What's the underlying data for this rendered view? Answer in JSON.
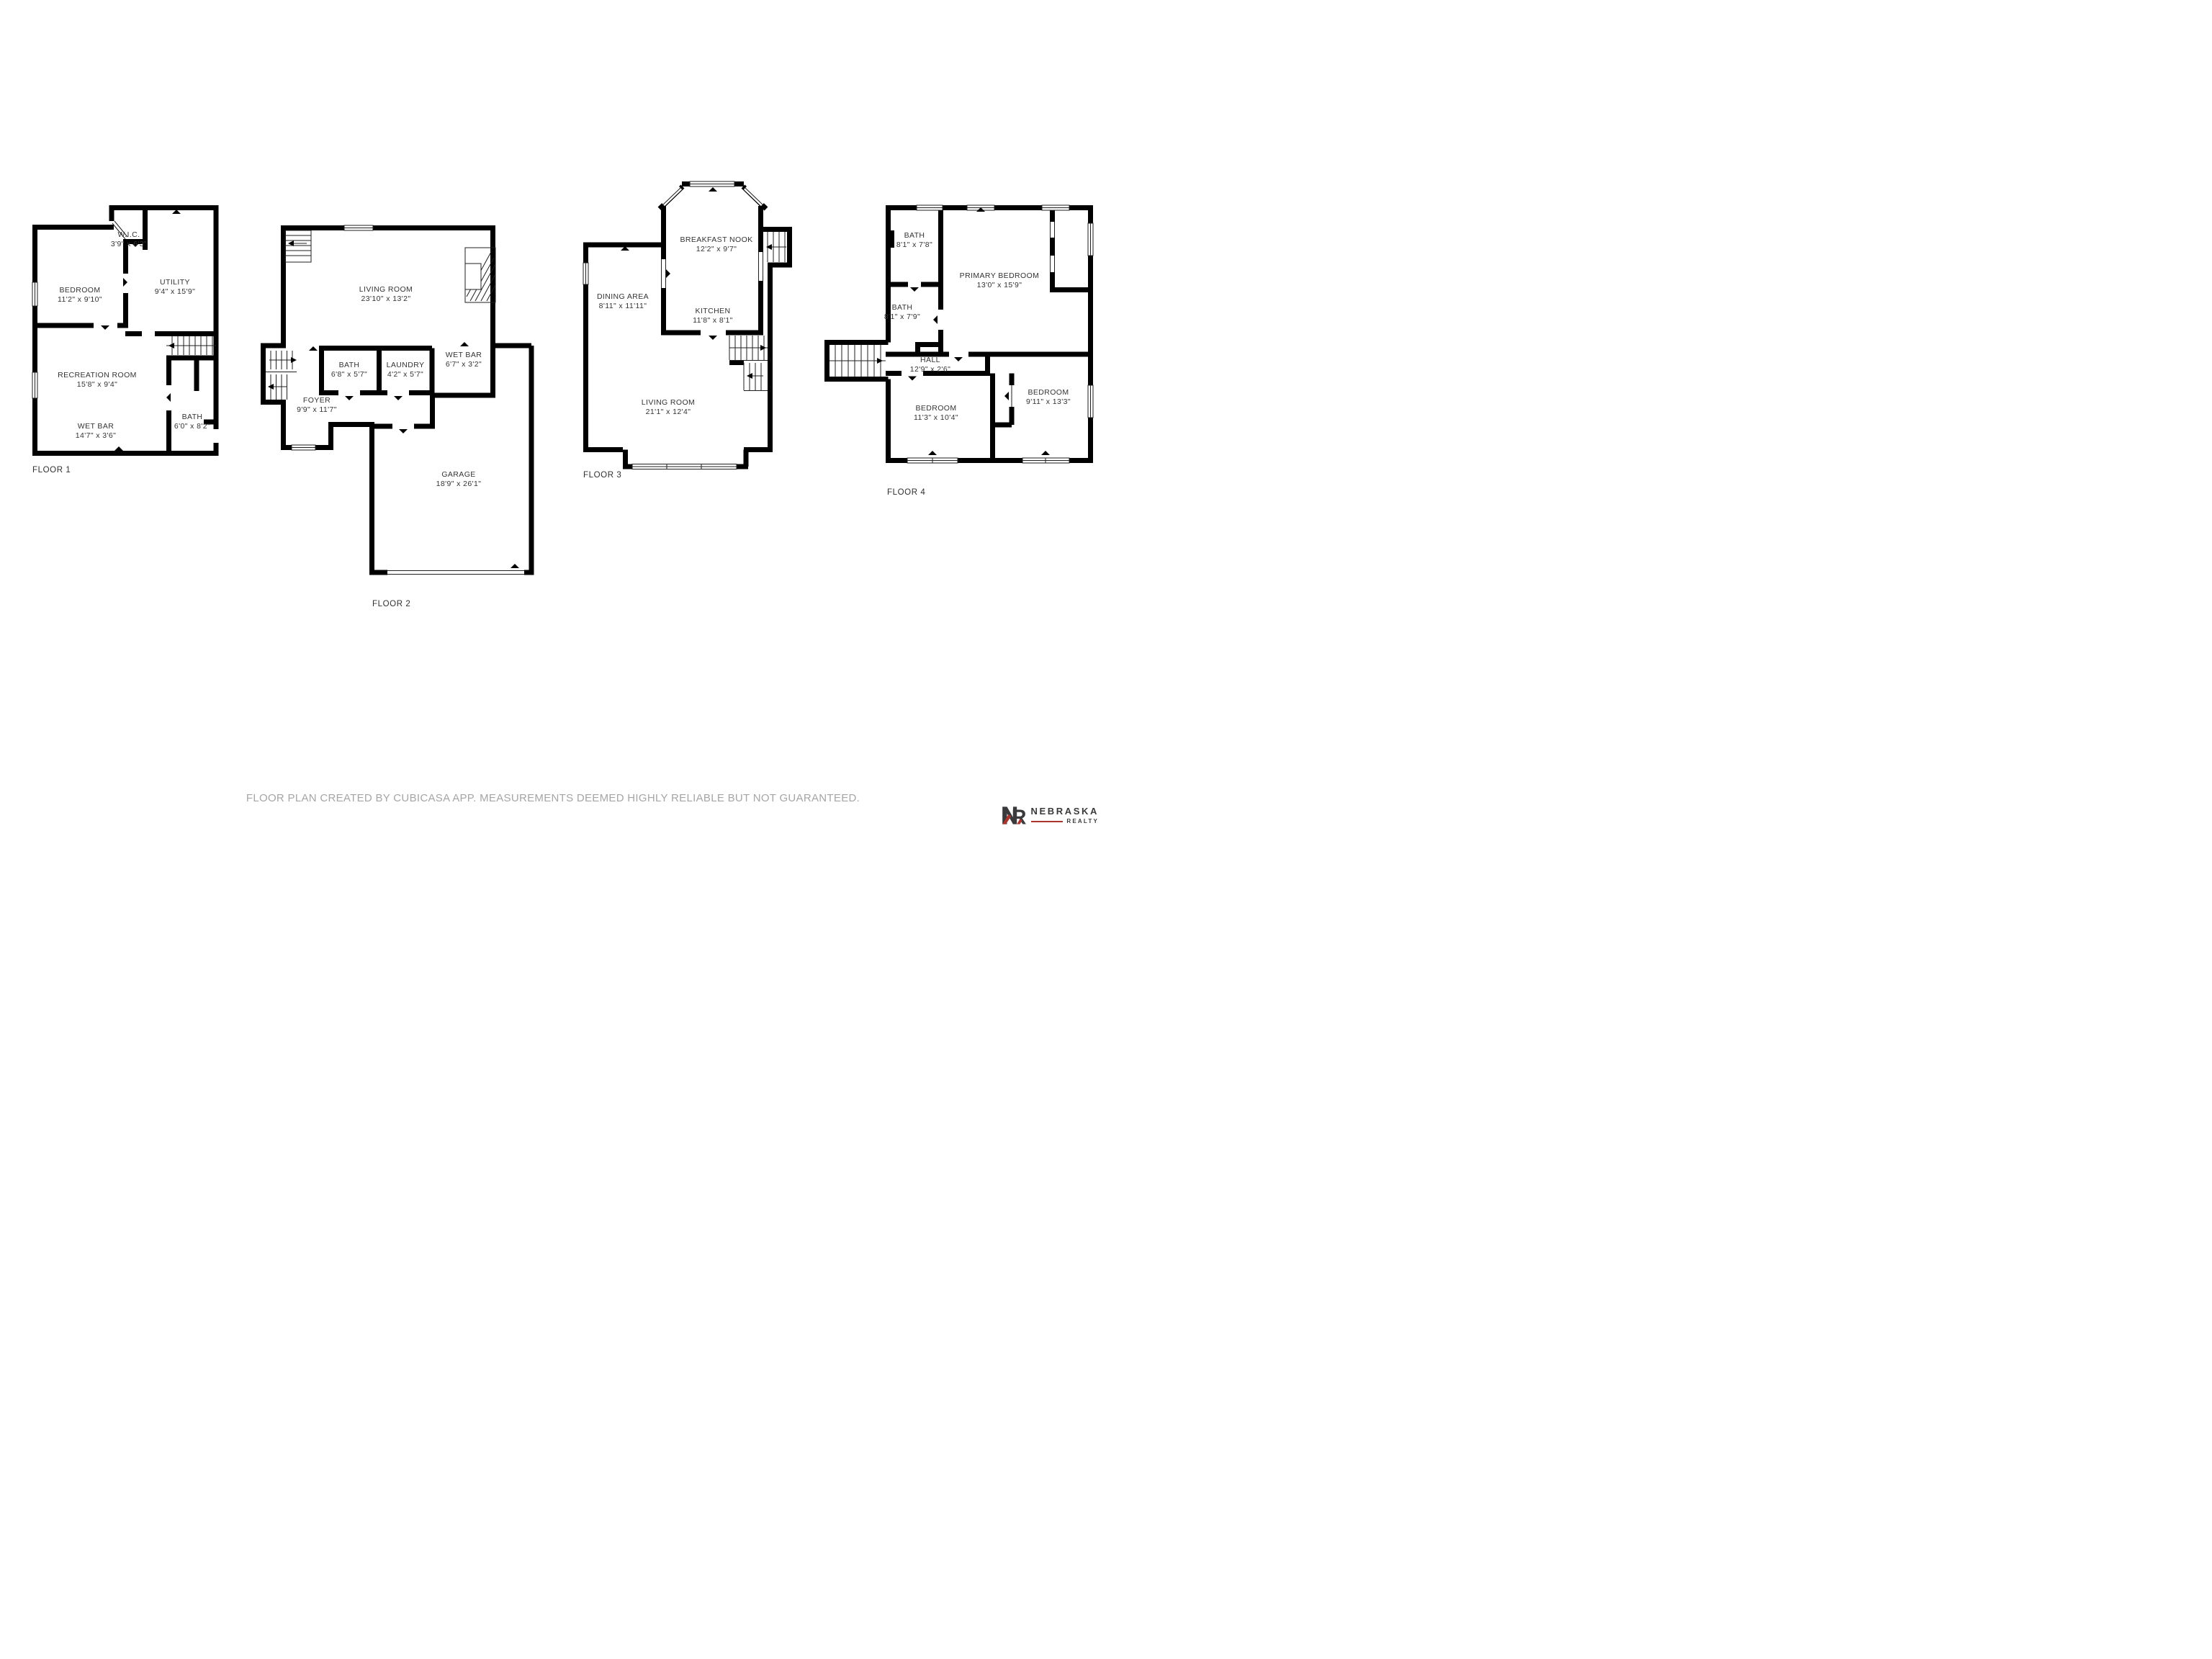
{
  "floors": [
    {
      "id": "floor-1",
      "label": "FLOOR 1",
      "rooms": [
        {
          "name": "W.I.C.",
          "dims": "3'9\" x 6'3\""
        },
        {
          "name": "BEDROOM",
          "dims": "11'2\" x 9'10\""
        },
        {
          "name": "UTILITY",
          "dims": "9'4\" x 15'9\""
        },
        {
          "name": "RECREATION ROOM",
          "dims": "15'8\" x 9'4\""
        },
        {
          "name": "WET BAR",
          "dims": "14'7\" x 3'6\""
        },
        {
          "name": "BATH",
          "dims": "6'0\" x 8'2\""
        }
      ]
    },
    {
      "id": "floor-2",
      "label": "FLOOR 2",
      "rooms": [
        {
          "name": "LIVING ROOM",
          "dims": "23'10\" x 13'2\""
        },
        {
          "name": "BATH",
          "dims": "6'8\" x 5'7\""
        },
        {
          "name": "LAUNDRY",
          "dims": "4'2\" x 5'7\""
        },
        {
          "name": "WET BAR",
          "dims": "6'7\" x 3'2\""
        },
        {
          "name": "FOYER",
          "dims": "9'9\" x 11'7\""
        },
        {
          "name": "GARAGE",
          "dims": "18'9\" x 26'1\""
        }
      ]
    },
    {
      "id": "floor-3",
      "label": "FLOOR 3",
      "rooms": [
        {
          "name": "BREAKFAST NOOK",
          "dims": "12'2\" x 9'7\""
        },
        {
          "name": "DINING AREA",
          "dims": "8'11\" x 11'11\""
        },
        {
          "name": "KITCHEN",
          "dims": "11'8\" x 8'1\""
        },
        {
          "name": "LIVING ROOM",
          "dims": "21'1\" x 12'4\""
        }
      ]
    },
    {
      "id": "floor-4",
      "label": "FLOOR 4",
      "rooms": [
        {
          "name": "BATH",
          "dims": "8'1\" x 7'8\""
        },
        {
          "name": "BATH",
          "dims": "8'1\" x 7'9\""
        },
        {
          "name": "PRIMARY BEDROOM",
          "dims": "13'0\" x 15'9\""
        },
        {
          "name": "HALL",
          "dims": "12'9\" x 2'6\""
        },
        {
          "name": "BEDROOM",
          "dims": "11'3\" x 10'4\""
        },
        {
          "name": "BEDROOM",
          "dims": "9'11\" x 13'3\""
        }
      ]
    }
  ],
  "footer": {
    "disclaimer": "FLOOR PLAN CREATED BY CUBICASA APP. MEASUREMENTS DEEMED HIGHLY RELIABLE BUT NOT GUARANTEED."
  },
  "logo": {
    "monogram": "NR",
    "brand": "NEBRASKA",
    "sub": "REALTY"
  },
  "colors": {
    "wall": "#000000",
    "room_label": "#333333",
    "disclaimer": "#a5a5a5",
    "brand_dark": "#3a3a3c",
    "brand_red": "#a8352e"
  }
}
